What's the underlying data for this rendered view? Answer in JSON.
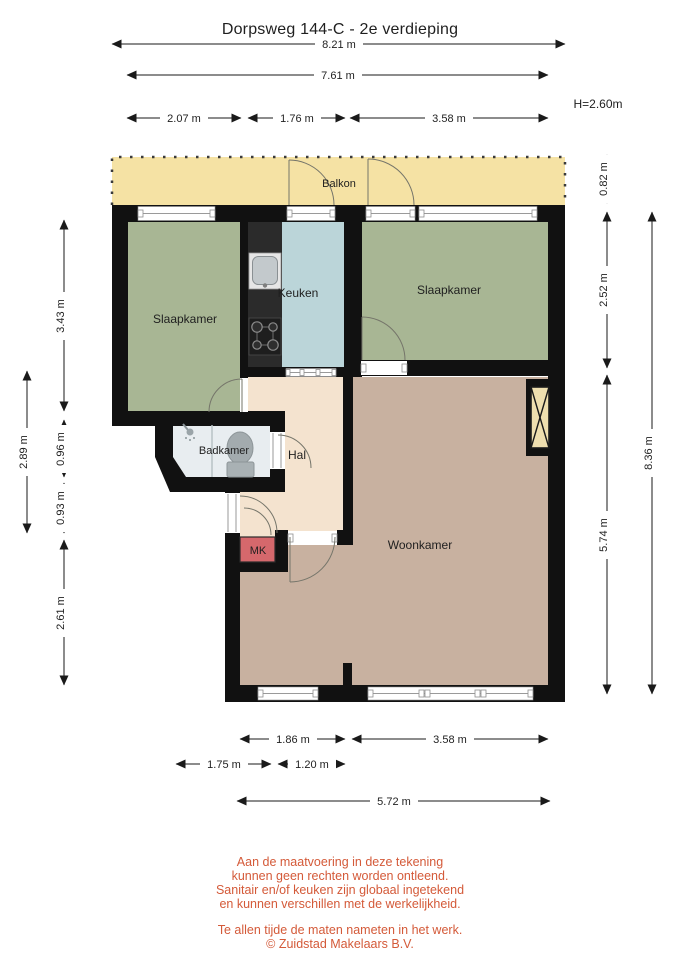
{
  "title": "Dorpsweg 144-C - 2e verdieping",
  "ceiling_height": "H=2.60m",
  "rooms": {
    "balkon": {
      "label": "Balkon",
      "color": "#F5E2A4"
    },
    "slaapkamer_left": {
      "label": "Slaapkamer",
      "color": "#A8B694"
    },
    "keuken": {
      "label": "Keuken",
      "color": "#BBD5D9"
    },
    "slaapkamer_right": {
      "label": "Slaapkamer",
      "color": "#A8B694"
    },
    "badkamer": {
      "label": "Badkamer",
      "color": "#E8EDF0"
    },
    "hal": {
      "label": "Hal",
      "color": "#F4E3CF"
    },
    "mk": {
      "label": "MK",
      "color": "#D5686C"
    },
    "woonkamer": {
      "label": "Woonkamer",
      "color": "#C8B1A0"
    }
  },
  "dimensions": {
    "top_total": "8.21 m",
    "top_inner": "7.61 m",
    "top_a": "2.07 m",
    "top_b": "1.76 m",
    "top_c": "3.58 m",
    "left_a": "3.43 m",
    "left_b": "0.96 m",
    "left_c": "0.93 m",
    "left_d": "2.61 m",
    "left_outer": "2.89 m",
    "right_a": "0.82 m",
    "right_b": "2.52 m",
    "right_c": "5.74 m",
    "right_outer": "8.36 m",
    "bottom_a": "1.86 m",
    "bottom_b": "3.58 m",
    "bottom_c": "1.75 m",
    "bottom_d": "1.20 m",
    "bottom_total": "5.72 m"
  },
  "disclaimer": {
    "line1": "Aan de maatvoering in deze tekening",
    "line2": "kunnen geen rechten worden ontleend.",
    "line3": "Sanitair en/of keuken zijn globaal ingetekend",
    "line4": "en kunnen verschillen met de werkelijkheid.",
    "line5": "Te allen tijde de maten nameten in het werk.",
    "line6": "© Zuidstad Makelaars B.V."
  }
}
